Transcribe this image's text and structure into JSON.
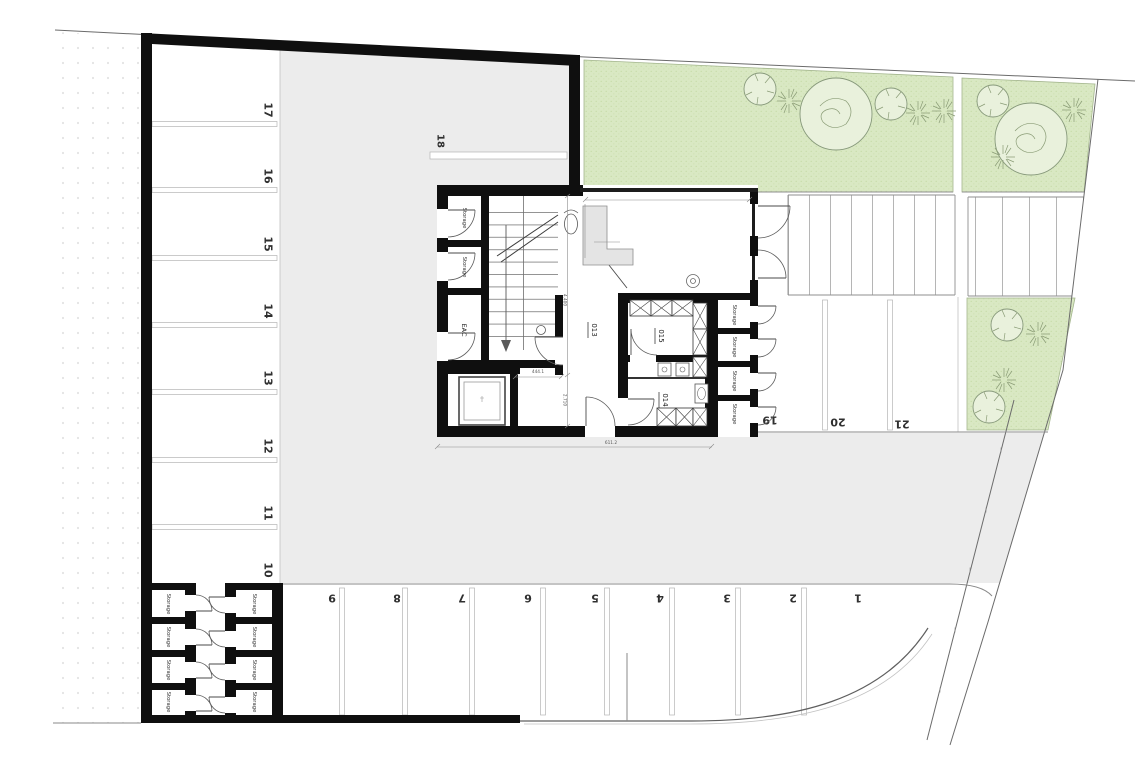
{
  "plan_labels": {
    "storage": "Storage",
    "eac": "EAC",
    "room_013": "013",
    "room_014": "014",
    "room_015": "015"
  },
  "parking": {
    "left": [
      "17",
      "16",
      "15",
      "14",
      "13",
      "12",
      "11",
      "10"
    ],
    "top": "18",
    "bottom": [
      "9",
      "8",
      "7",
      "6",
      "5",
      "4",
      "3",
      "2",
      "1"
    ],
    "right": [
      "19",
      "20",
      "21"
    ]
  },
  "dimensions": {
    "stair_bay_height": "4.400",
    "lower_bay_height": "2.710",
    "building_width": "611.2",
    "corridor_width": "444.1"
  },
  "colors": {
    "driveway": "#ececec",
    "lawn": "#d9e8c3",
    "lawn_dot": "#c3d9a3",
    "wall": "#0f0f0f",
    "line": "#8a8a8a",
    "tree_fill": "#e9f1dc"
  }
}
